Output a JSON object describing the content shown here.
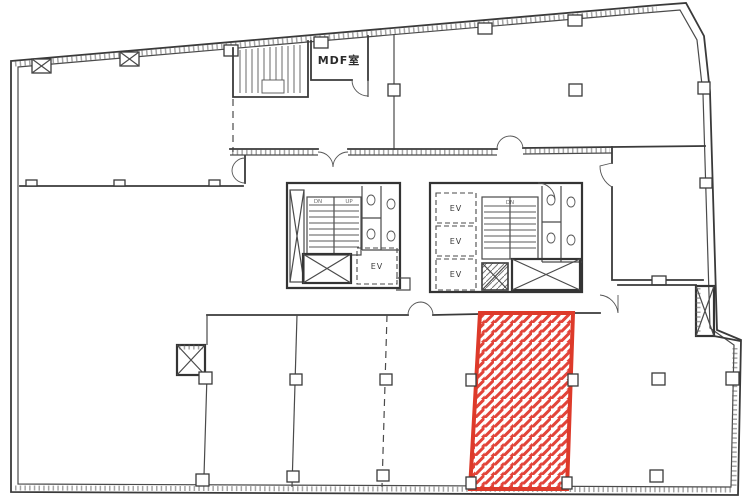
{
  "plan": {
    "labels": {
      "mdf_room": "MDF室",
      "elevator": "EV",
      "stair_down": "DN",
      "stair_up": "UP"
    },
    "highlighted_unit": {
      "style": "red-diagonal-hatch",
      "border_color": "#dd3a2a",
      "stripe_color": "#e2443a"
    },
    "colors": {
      "wall_line": "#3a3a3a",
      "background": "#ffffff",
      "highlight_red": "#dd3a2a"
    }
  }
}
